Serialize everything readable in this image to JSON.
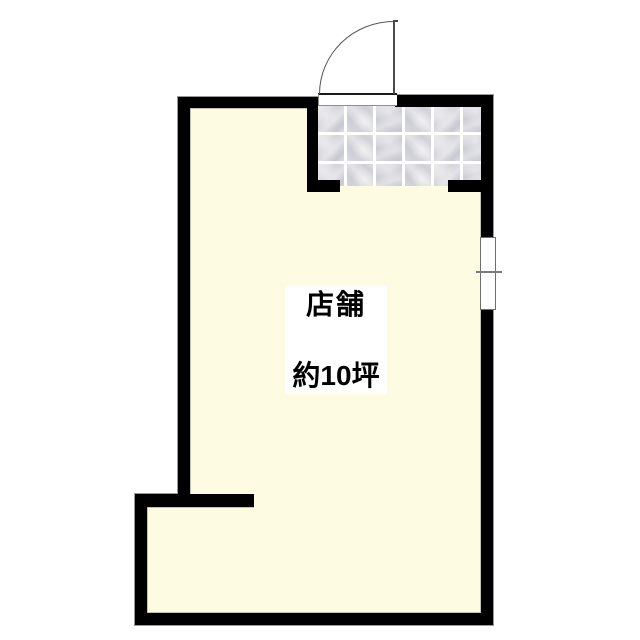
{
  "floorplan": {
    "room_label": "店舗",
    "area_label": "約10坪",
    "features": {
      "entrance_door": "hinged-door-quarter-arc",
      "entrance_floor": "tiled",
      "window": "right-wall-single-window"
    },
    "colors": {
      "wall": "#000000",
      "floor": "#FDFCE2",
      "tile": "#D5D5DC",
      "tile_grout": "#FFFFFF",
      "background": "#FFFFFF",
      "door_line": "#555555"
    }
  }
}
